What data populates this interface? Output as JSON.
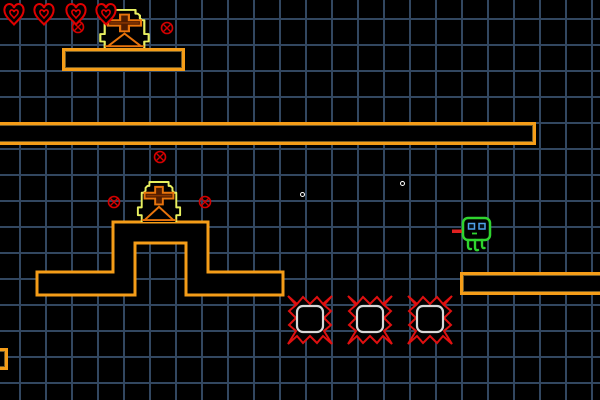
{
  "scene": {
    "width": 600,
    "height": 400,
    "colors": {
      "background": "#000000",
      "grid_line": "#324760",
      "platform_border": "#f59d18",
      "heart_red": "#e00000",
      "marker_red": "#d40000",
      "spike_red": "#e01010",
      "spike_inner": "#d8d8d8",
      "statue_outline": "#e8f060",
      "statue_inner": "#e8740c",
      "statue_inner_dark": "#8a3600",
      "player_green": "#2fd42f",
      "player_eye": "#4fa0e8",
      "player_tongue": "#e02020",
      "sparkle_white": "#ffffff"
    },
    "grid": {
      "cell": 26,
      "offset_x": 19,
      "offset_y": 18,
      "line_width": 2
    },
    "hud": {
      "hearts_count": 4,
      "heart_size": {
        "w": 22,
        "h": 24
      },
      "heart_positions": [
        {
          "x": 3,
          "y": 2
        },
        {
          "x": 33,
          "y": 2
        },
        {
          "x": 65,
          "y": 2
        },
        {
          "x": 95,
          "y": 2
        }
      ]
    },
    "platforms": [
      {
        "name": "platform-top-left",
        "x": 62,
        "y": 48,
        "w": 123,
        "h": 23
      },
      {
        "name": "platform-long",
        "x": -6,
        "y": 122,
        "w": 542,
        "h": 23
      },
      {
        "name": "platform-right",
        "x": 460,
        "y": 272,
        "w": 150,
        "h": 23
      },
      {
        "name": "platform-bottom-left-stub",
        "x": -16,
        "y": 348,
        "w": 24,
        "h": 22
      }
    ],
    "gate_structure": {
      "name": "platform-gate",
      "path": "M37,272 H113 V222 H208 V272 H283 V295 H186 V243 H135 V295 H37 Z"
    },
    "statues": [
      {
        "x": 97,
        "y": 9,
        "w": 55,
        "h": 39
      },
      {
        "x": 135,
        "y": 181,
        "w": 48,
        "h": 41
      }
    ],
    "markers": [
      {
        "x": 78,
        "y": 27
      },
      {
        "x": 167,
        "y": 28
      },
      {
        "x": 160,
        "y": 157
      },
      {
        "x": 114,
        "y": 202
      },
      {
        "x": 205,
        "y": 202
      }
    ],
    "spike_blocks": [
      {
        "x": 285,
        "y": 293
      },
      {
        "x": 345,
        "y": 293
      },
      {
        "x": 405,
        "y": 293
      }
    ],
    "spike_size": {
      "w": 50,
      "h": 54
    },
    "sparkles": [
      {
        "x": 302,
        "y": 194
      },
      {
        "x": 402,
        "y": 183
      }
    ],
    "player": {
      "x": 452,
      "y": 216,
      "w": 40,
      "h": 36
    }
  }
}
